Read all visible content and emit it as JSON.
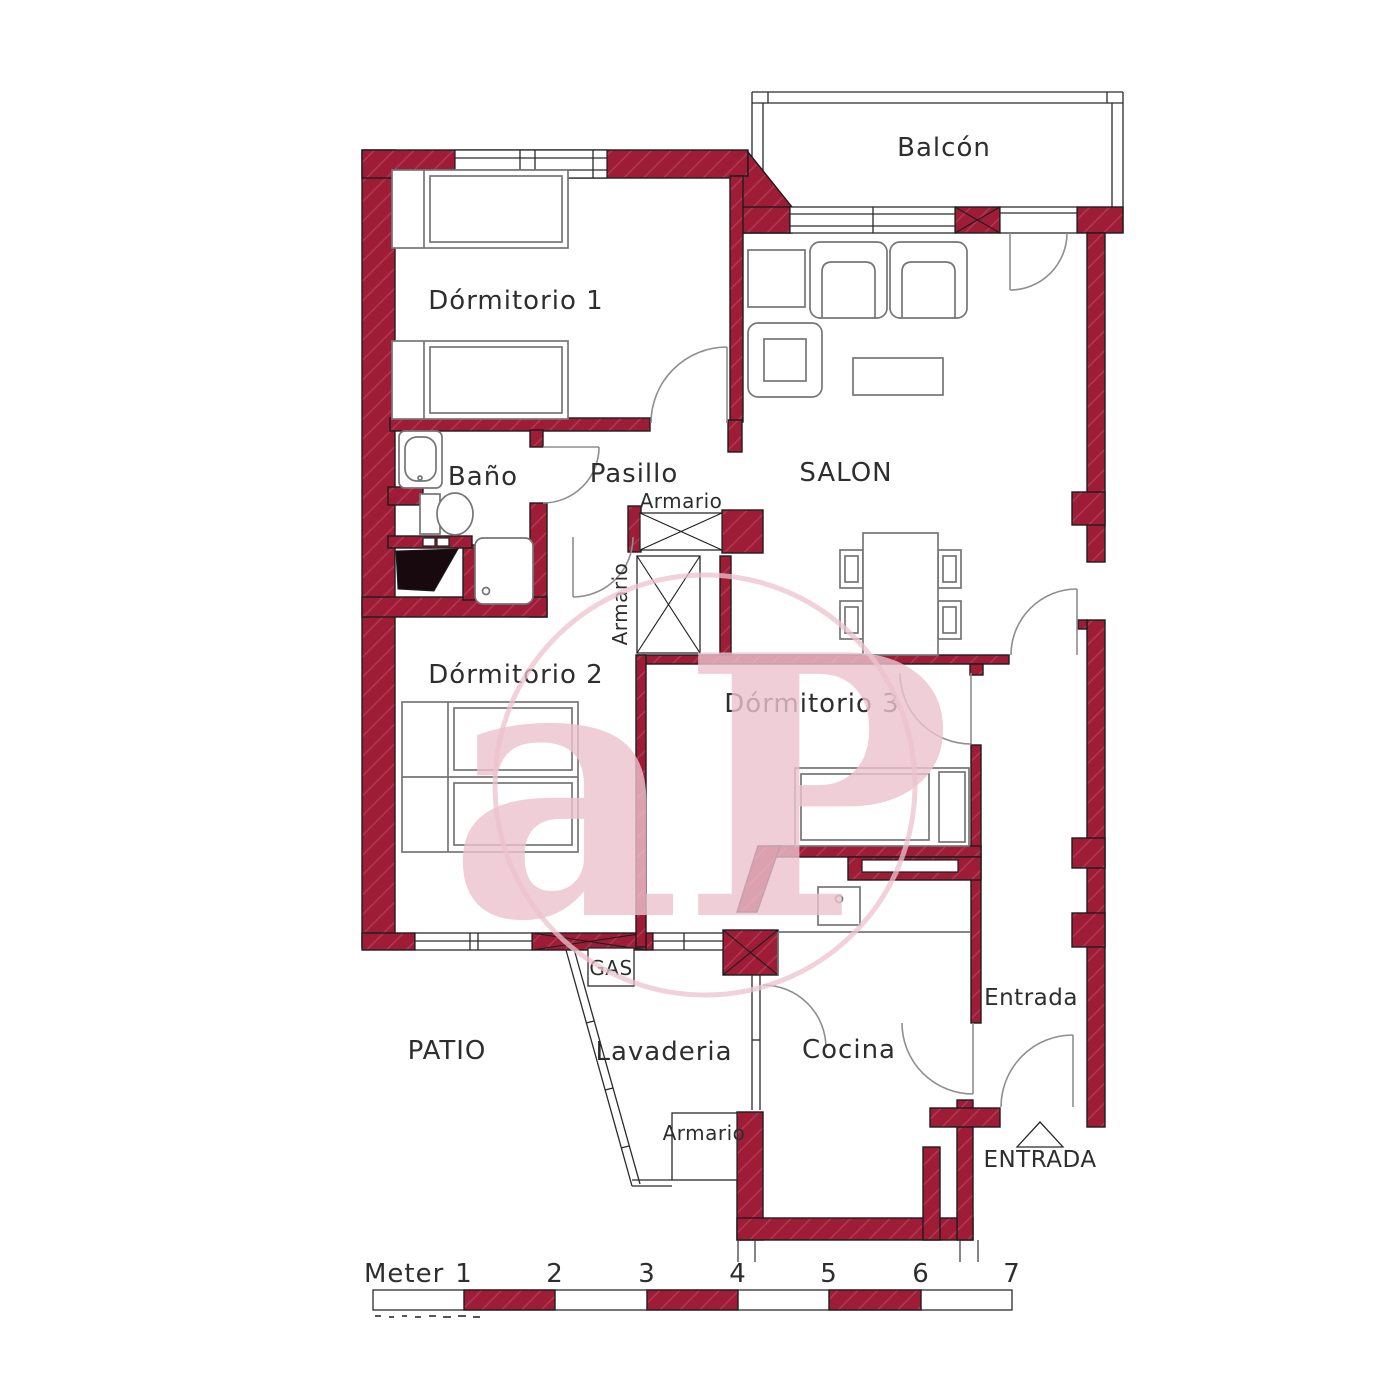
{
  "colors": {
    "wall": "#9e1c36",
    "hatch": "#b23a55",
    "outline": "#1c1c1c",
    "furniture": "#757575",
    "door": "#8e8e8e",
    "text": "#2e2e2e",
    "watermark": "#ecc3ce"
  },
  "rooms": {
    "balcony": {
      "label": "Balcón"
    },
    "bedroom1": {
      "label": "Dórmitorio 1"
    },
    "bathroom": {
      "label": "Baño"
    },
    "hallway": {
      "label": "Pasillo"
    },
    "living": {
      "label": "SALON"
    },
    "bedroom2": {
      "label": "Dórmitorio 2"
    },
    "bedroom3": {
      "label": "Dórmitorio 3"
    },
    "patio": {
      "label": "PATIO"
    },
    "laundry": {
      "label": "Lavaderia"
    },
    "kitchen": {
      "label": "Cocina"
    },
    "entry_hall": {
      "label": "Entrada"
    }
  },
  "labels": {
    "closet_top": "Armario",
    "closet_mid": "Armario",
    "closet_bottom": "Armario",
    "gas": "GAS",
    "entrance_arrow": "ENTRADA"
  },
  "scale": {
    "unit": "Meter",
    "ticks": [
      "1",
      "2",
      "3",
      "4",
      "5",
      "6",
      "7"
    ]
  },
  "watermark": {
    "text": "aP"
  }
}
